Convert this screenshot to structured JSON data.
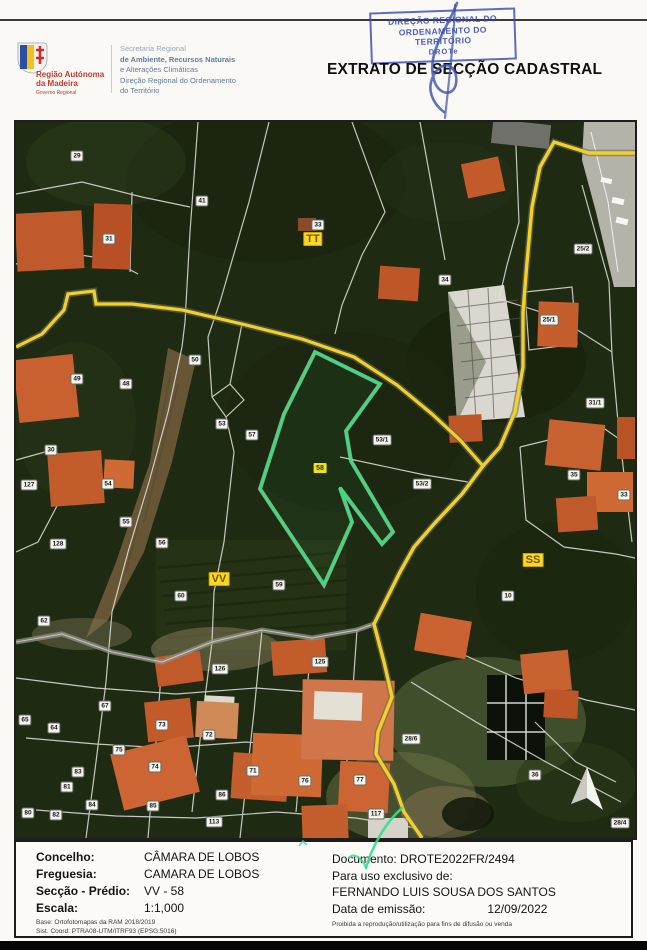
{
  "header": {
    "title": "EXTRATO DE SECÇÃO CADASTRAL",
    "stamp": {
      "lines": [
        "DIREÇÃO REGIONAL DO",
        "ORDENAMENTO DO",
        "TERRITÓRIO",
        "DROTe"
      ]
    },
    "logo": {
      "region_line1": "Região Autónoma",
      "region_line2": "da Madeira",
      "sub": "Governo Regional"
    },
    "secretariat_lines": [
      "Secretaria Regional",
      "de Ambiente, Recursos Naturais",
      "e Alterações Climáticas",
      "Direção Regional do Ordenamento",
      "do Território"
    ]
  },
  "map": {
    "colors": {
      "parcel_outline": "#29e57d",
      "road": "#f2d024",
      "section_label_bg": "#ffd71e",
      "boundary_line": "#e4e4de"
    },
    "section_labels": [
      {
        "t": "TT",
        "x": 297,
        "y": 117
      },
      {
        "t": "VV",
        "x": 203,
        "y": 457
      },
      {
        "t": "SS",
        "x": 517,
        "y": 438
      }
    ],
    "highlight_label": {
      "t": "58",
      "x": 304,
      "y": 346
    },
    "parcel_labels": [
      {
        "t": "29",
        "x": 61,
        "y": 34
      },
      {
        "t": "41",
        "x": 186,
        "y": 79
      },
      {
        "t": "31",
        "x": 93,
        "y": 117
      },
      {
        "t": "33",
        "x": 302,
        "y": 103
      },
      {
        "t": "34",
        "x": 429,
        "y": 158
      },
      {
        "t": "25/2",
        "x": 567,
        "y": 127
      },
      {
        "t": "25/1",
        "x": 533,
        "y": 198
      },
      {
        "t": "50",
        "x": 179,
        "y": 238
      },
      {
        "t": "49",
        "x": 61,
        "y": 257
      },
      {
        "t": "48",
        "x": 110,
        "y": 262
      },
      {
        "t": "53",
        "x": 206,
        "y": 302
      },
      {
        "t": "57",
        "x": 236,
        "y": 313
      },
      {
        "t": "30",
        "x": 35,
        "y": 328
      },
      {
        "t": "127",
        "x": 13,
        "y": 363
      },
      {
        "t": "54",
        "x": 92,
        "y": 362
      },
      {
        "t": "55",
        "x": 110,
        "y": 400
      },
      {
        "t": "128",
        "x": 42,
        "y": 422
      },
      {
        "t": "56",
        "x": 146,
        "y": 421
      },
      {
        "t": "53/1",
        "x": 366,
        "y": 318
      },
      {
        "t": "53/2",
        "x": 406,
        "y": 362
      },
      {
        "t": "59",
        "x": 263,
        "y": 463
      },
      {
        "t": "31/1",
        "x": 579,
        "y": 281
      },
      {
        "t": "35",
        "x": 558,
        "y": 353
      },
      {
        "t": "33",
        "x": 608,
        "y": 373
      },
      {
        "t": "10",
        "x": 492,
        "y": 474
      },
      {
        "t": "60",
        "x": 165,
        "y": 474
      },
      {
        "t": "62",
        "x": 28,
        "y": 499
      },
      {
        "t": "126",
        "x": 204,
        "y": 547
      },
      {
        "t": "125",
        "x": 304,
        "y": 540
      },
      {
        "t": "67",
        "x": 89,
        "y": 584
      },
      {
        "t": "65",
        "x": 9,
        "y": 598
      },
      {
        "t": "64",
        "x": 38,
        "y": 606
      },
      {
        "t": "73",
        "x": 146,
        "y": 603
      },
      {
        "t": "72",
        "x": 193,
        "y": 613
      },
      {
        "t": "75",
        "x": 103,
        "y": 628
      },
      {
        "t": "28/6",
        "x": 395,
        "y": 617
      },
      {
        "t": "83",
        "x": 62,
        "y": 650
      },
      {
        "t": "74",
        "x": 139,
        "y": 645
      },
      {
        "t": "71",
        "x": 237,
        "y": 649
      },
      {
        "t": "76",
        "x": 289,
        "y": 659
      },
      {
        "t": "81",
        "x": 51,
        "y": 665
      },
      {
        "t": "36",
        "x": 519,
        "y": 653
      },
      {
        "t": "77",
        "x": 344,
        "y": 658
      },
      {
        "t": "84",
        "x": 76,
        "y": 683
      },
      {
        "t": "85",
        "x": 137,
        "y": 684
      },
      {
        "t": "86",
        "x": 206,
        "y": 673
      },
      {
        "t": "80",
        "x": 12,
        "y": 691
      },
      {
        "t": "82",
        "x": 40,
        "y": 693
      },
      {
        "t": "113",
        "x": 198,
        "y": 700
      },
      {
        "t": "117",
        "x": 360,
        "y": 692
      },
      {
        "t": "28/4",
        "x": 604,
        "y": 701
      }
    ]
  },
  "footer": {
    "left_rows": [
      {
        "label": "Concelho:",
        "value": "CÂMARA DE LOBOS"
      },
      {
        "label": "Freguesia:",
        "value": "CAMARA DE LOBOS"
      },
      {
        "label": "Secção - Prédio:",
        "value": "VV - 58"
      },
      {
        "label": "Escala:",
        "value": "1:1,000"
      }
    ],
    "left_small": [
      "Base: Ortofotomapas da RAM 2018/2019",
      "Sist. Coord: PTRA08-UTM/ITRF93 (EPSG:5016)"
    ],
    "right": {
      "documento_label": "Documento:",
      "documento_value": "DROTE2022FR/2494",
      "uso_line": "Para uso exclusivo de:",
      "name": "FERNANDO LUIS SOUSA DOS SANTOS",
      "data_label": "Data de emissão:",
      "data_value": "12/09/2022",
      "small": "Proibida a reprodução/utilização para fins de difusão ou venda"
    }
  }
}
